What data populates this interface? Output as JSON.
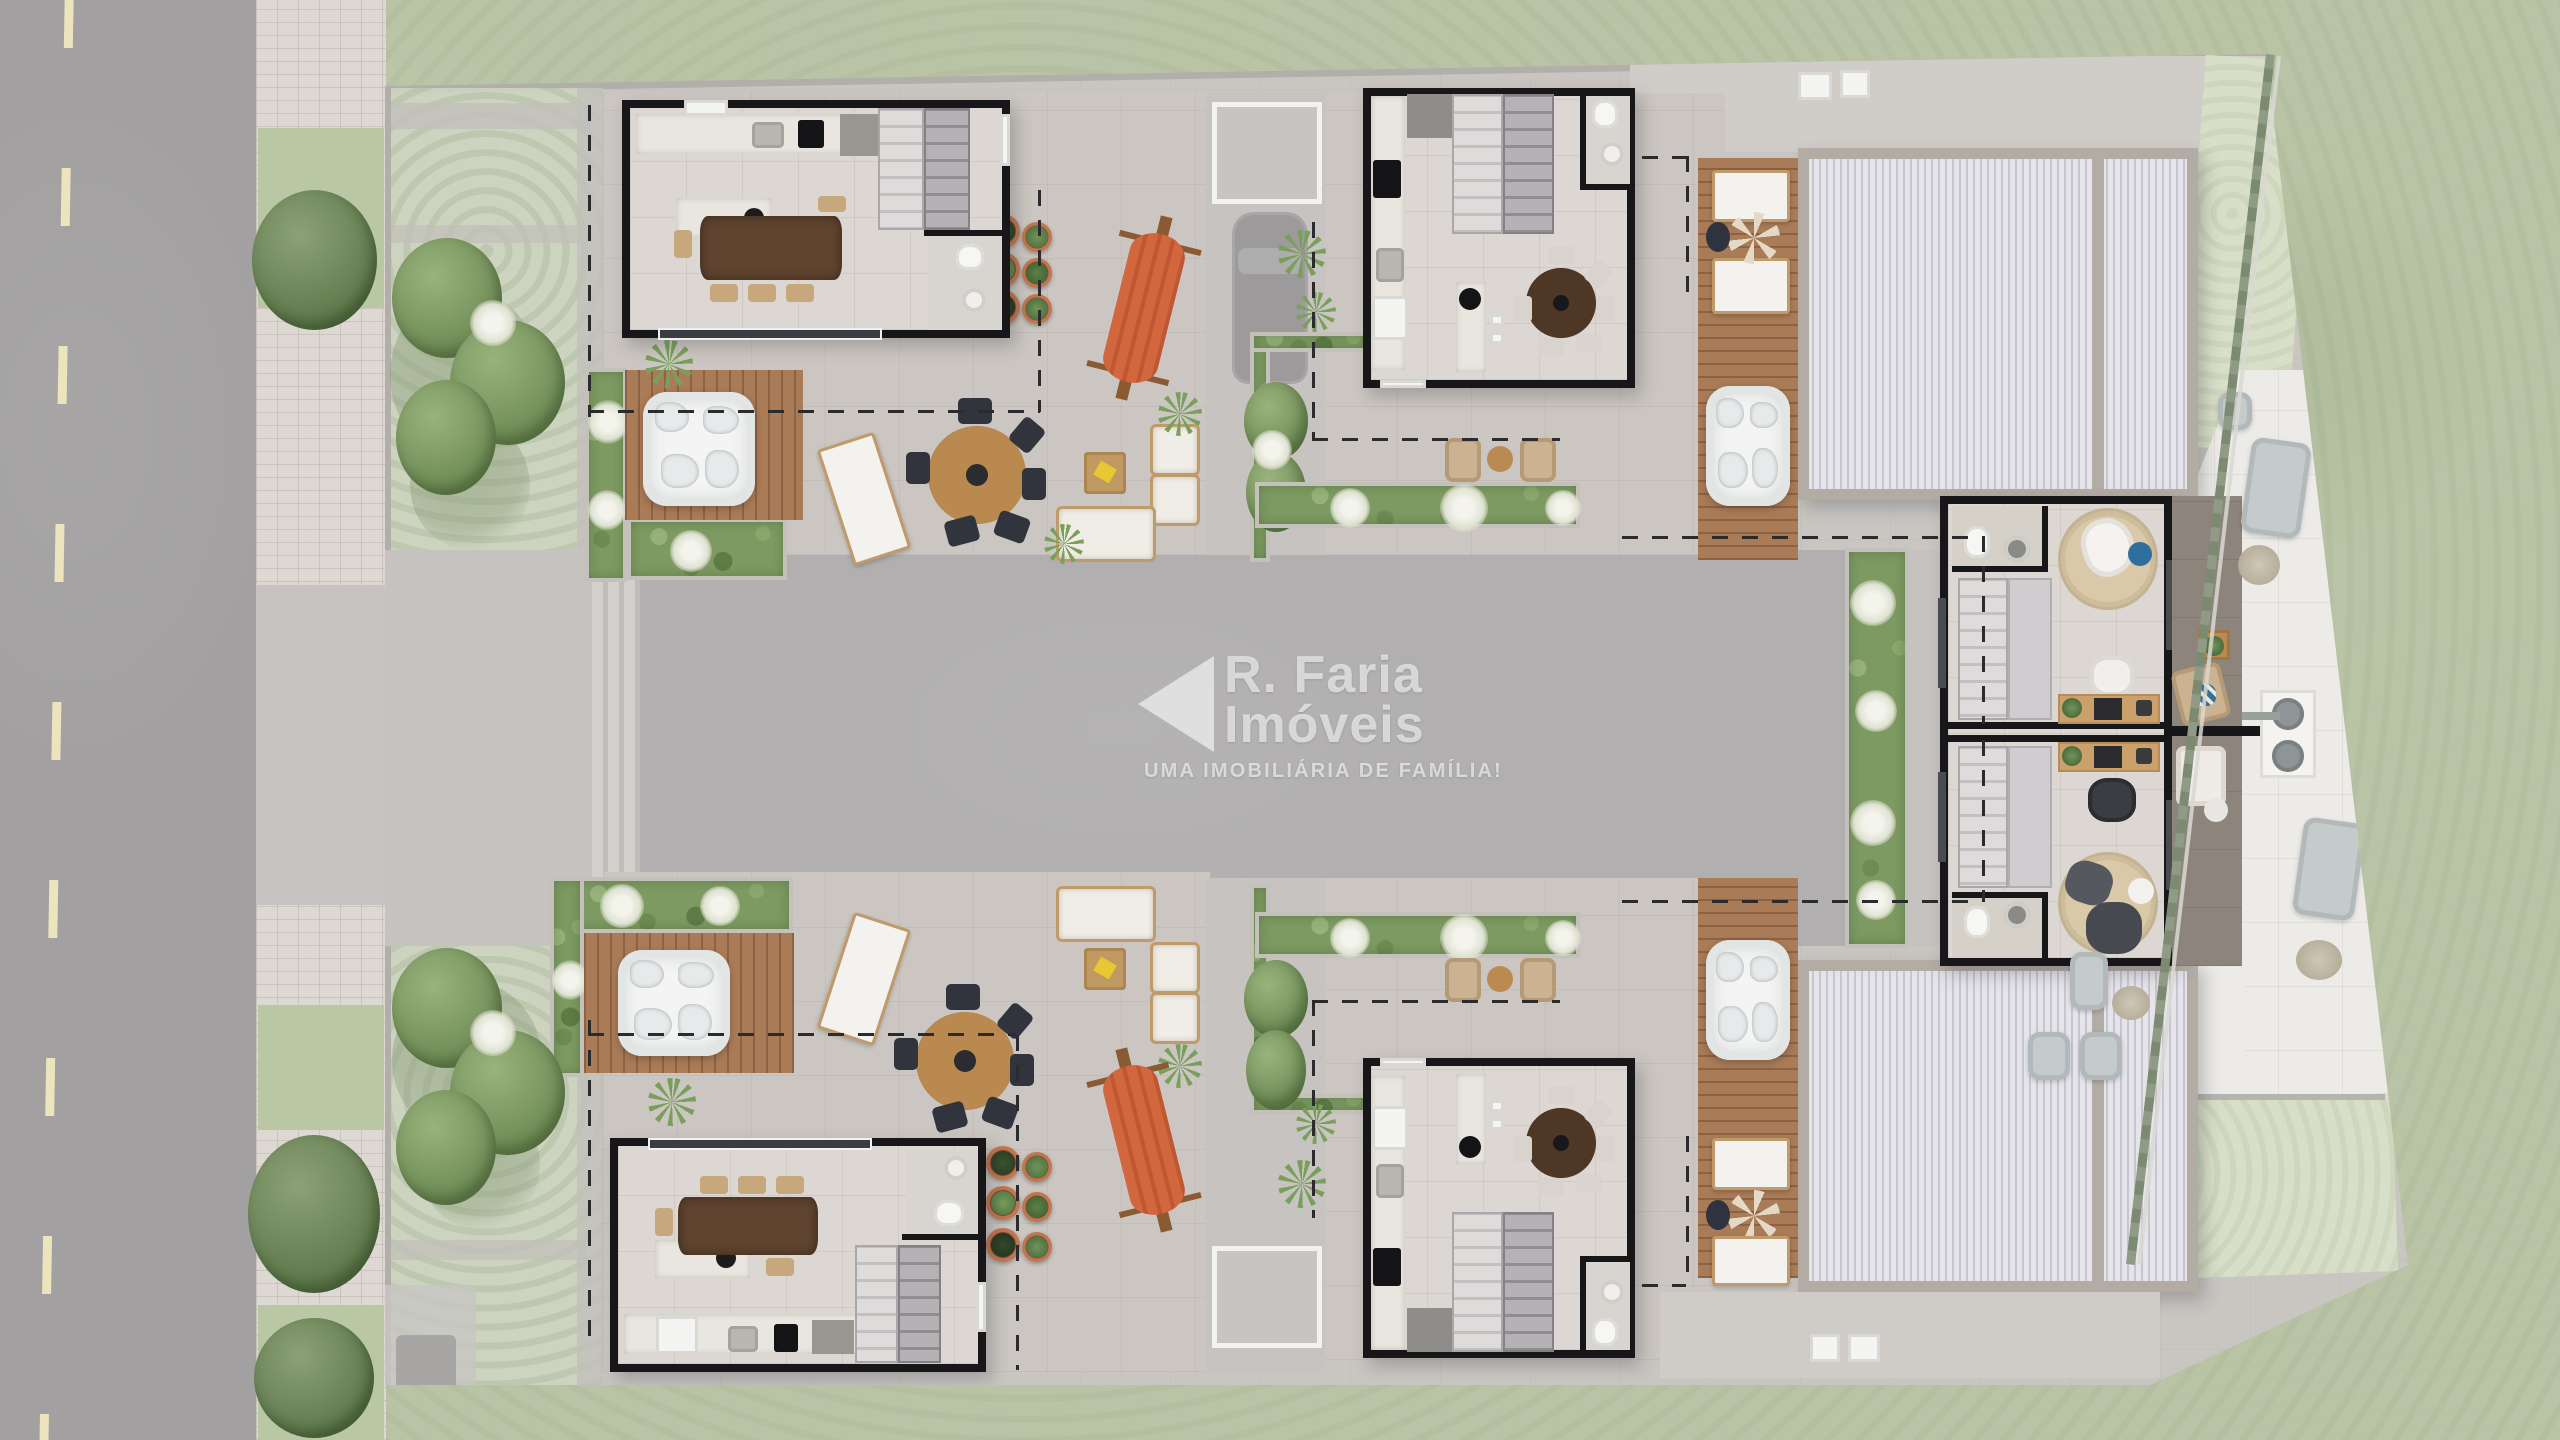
{
  "watermark": {
    "logo": "left-triangle-icon",
    "brand_line1": "R. Faria",
    "brand_line2": "Imóveis",
    "tagline": "UMA IMOBILIÁRIA DE FAMÍLIA!"
  },
  "scene": {
    "type": "top-down architectural floor plan render of a residential condominium upper level",
    "site_elements": [
      "street with dashed lane marking",
      "paver sidewalk with planting strips",
      "faded ground-floor garden",
      "central concrete courtyard driveway",
      "ghost parked car",
      "lawns",
      "diagonal rear fence with hedge"
    ],
    "penthouse_units": [
      "kitchen and dining room",
      "staircase",
      "bathroom",
      "kitchen island",
      "wood dining table",
      "roof terrace",
      "wood deck",
      "hot tub",
      "sun loungers",
      "outdoor round dining table",
      "hammock",
      "potted plants",
      "outdoor sofa",
      "armchairs",
      "coffee table",
      "planter hedges",
      "ceiling fan",
      "corrugated roof"
    ],
    "studio_units": [
      "staircase",
      "bathroom",
      "round rug",
      "lounge chair",
      "desk with laptop",
      "office chair",
      "balcony with armchair and sofa"
    ],
    "rear_terrace": [
      "garden sofas",
      "ottoman",
      "barbecue grill table",
      "dry plants"
    ]
  },
  "palette": {
    "grass_outer": "#b9c4a6",
    "grass_lawn": "#d8dfc8",
    "asphalt": "#a2a0a0",
    "lane_marking": "#ebe4bd",
    "sidewalk_paver": "#ddd9d2",
    "concrete_apron": "#c9c6c2",
    "courtyard": "#b1afaf",
    "terrace_floor": "#cbc6c1",
    "room_floor": "#dcd7d2",
    "wall_black": "#17171a",
    "wood_deck": "#a97b57",
    "dining_wood": "#5f442f",
    "roof_corrugated": "#dcdbe2",
    "roof_frame": "#b3aca4",
    "planter_green": "#7d9a62",
    "hot_tub_white": "#f3f4f3",
    "hammock_orange": "#d2663c",
    "white_terrace": "#edebe7",
    "balcony_floor": "#8d857b",
    "accent_pillow_blue": "#2e6f9e",
    "watermark_white": "rgba(255,255,255,0.60)"
  }
}
